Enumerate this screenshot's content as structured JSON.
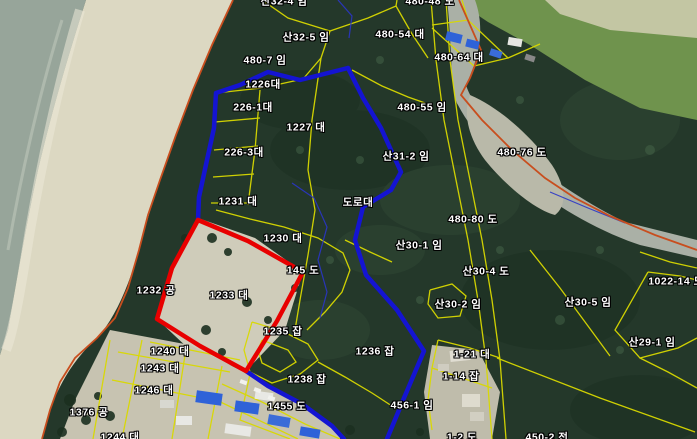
{
  "map": {
    "description": "cadastral-parcel-overlay-on-aerial-photo",
    "colors": {
      "red_highlight": "#e80000",
      "blue_highlight": "#1414d2",
      "parcel_line_yellow": "#d9d900",
      "boundary_line_orange": "#c84e1e",
      "thin_blue_line": "#2a35c8",
      "label_text": "#ffffff",
      "label_outline": "#000000",
      "sea": "#97a59a",
      "sand": "#dcd8c2",
      "forest": "#24382a"
    },
    "labels": [
      {
        "text": "산32-4 임",
        "x": 284,
        "y": 2
      },
      {
        "text": "480-48 도",
        "x": 430,
        "y": 2
      },
      {
        "text": "산32-5 임",
        "x": 306,
        "y": 38
      },
      {
        "text": "480-54 대",
        "x": 400,
        "y": 35
      },
      {
        "text": "480-64 대",
        "x": 459,
        "y": 58
      },
      {
        "text": "480-7 임",
        "x": 265,
        "y": 61
      },
      {
        "text": "1226대",
        "x": 263,
        "y": 85
      },
      {
        "text": "226-1대",
        "x": 253,
        "y": 108
      },
      {
        "text": "1227 대",
        "x": 306,
        "y": 128
      },
      {
        "text": "226-3대",
        "x": 244,
        "y": 153
      },
      {
        "text": "480-55 임",
        "x": 422,
        "y": 108
      },
      {
        "text": "산31-2 임",
        "x": 406,
        "y": 157
      },
      {
        "text": "480-76 도",
        "x": 522,
        "y": 153
      },
      {
        "text": "1231 대",
        "x": 238,
        "y": 202
      },
      {
        "text": "도로대",
        "x": 358,
        "y": 203
      },
      {
        "text": "1230 대",
        "x": 283,
        "y": 239
      },
      {
        "text": "480-80 도",
        "x": 473,
        "y": 220
      },
      {
        "text": "산30-1 임",
        "x": 419,
        "y": 246
      },
      {
        "text": "145 도",
        "x": 303,
        "y": 271
      },
      {
        "text": "산30-4 도",
        "x": 486,
        "y": 272
      },
      {
        "text": "1022-14 도",
        "x": 676,
        "y": 282
      },
      {
        "text": "1232 공",
        "x": 156,
        "y": 291
      },
      {
        "text": "1233 대",
        "x": 229,
        "y": 296
      },
      {
        "text": "산30-2 임",
        "x": 458,
        "y": 305
      },
      {
        "text": "산30-5 임",
        "x": 588,
        "y": 303
      },
      {
        "text": "1235 잡",
        "x": 283,
        "y": 332
      },
      {
        "text": "1236 잡",
        "x": 375,
        "y": 352
      },
      {
        "text": "산29-1 임",
        "x": 652,
        "y": 343
      },
      {
        "text": "1-21 대",
        "x": 472,
        "y": 355
      },
      {
        "text": "1240 대",
        "x": 170,
        "y": 352
      },
      {
        "text": "1243 대",
        "x": 160,
        "y": 369
      },
      {
        "text": "1-14 잡",
        "x": 461,
        "y": 377
      },
      {
        "text": "1238 잡",
        "x": 307,
        "y": 380
      },
      {
        "text": "1246 대",
        "x": 154,
        "y": 391
      },
      {
        "text": "456-1 임",
        "x": 412,
        "y": 406
      },
      {
        "text": "1455 도",
        "x": 287,
        "y": 407
      },
      {
        "text": "1376 공",
        "x": 89,
        "y": 413
      },
      {
        "text": "1244 대",
        "x": 120,
        "y": 438
      },
      {
        "text": "1-2 도",
        "x": 462,
        "y": 438
      },
      {
        "text": "450-2 전",
        "x": 547,
        "y": 438
      }
    ]
  }
}
